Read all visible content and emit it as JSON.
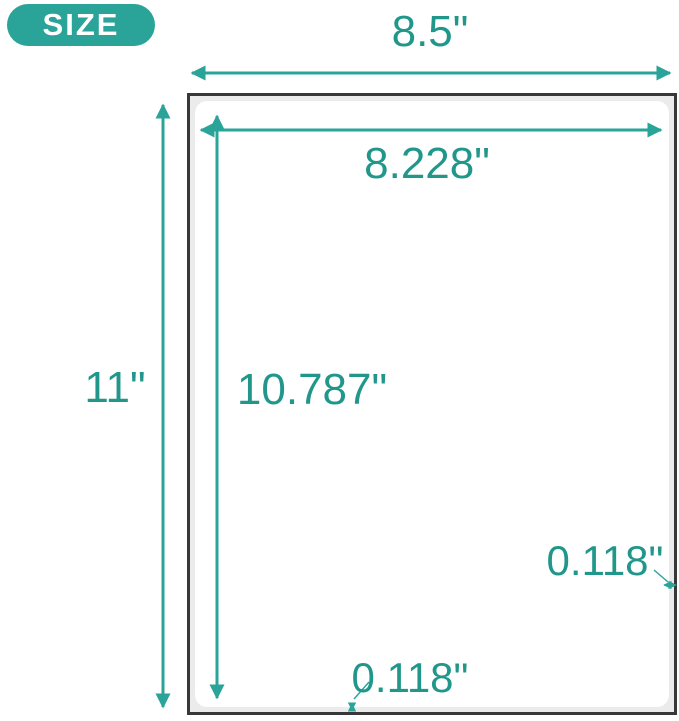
{
  "badge": {
    "label": "SIZE"
  },
  "dimensions": {
    "sheet_width": "8.5\"",
    "label_width": "8.228\"",
    "sheet_height": "11\"",
    "label_height": "10.787\"",
    "side_margin": "0.118\"",
    "bottom_margin": "0.118\""
  },
  "colors": {
    "accent": "#2aa398",
    "text": "#21978b",
    "sheet_border": "#383838",
    "sheet_fill": "#ebebeb",
    "label_fill": "#ffffff"
  }
}
